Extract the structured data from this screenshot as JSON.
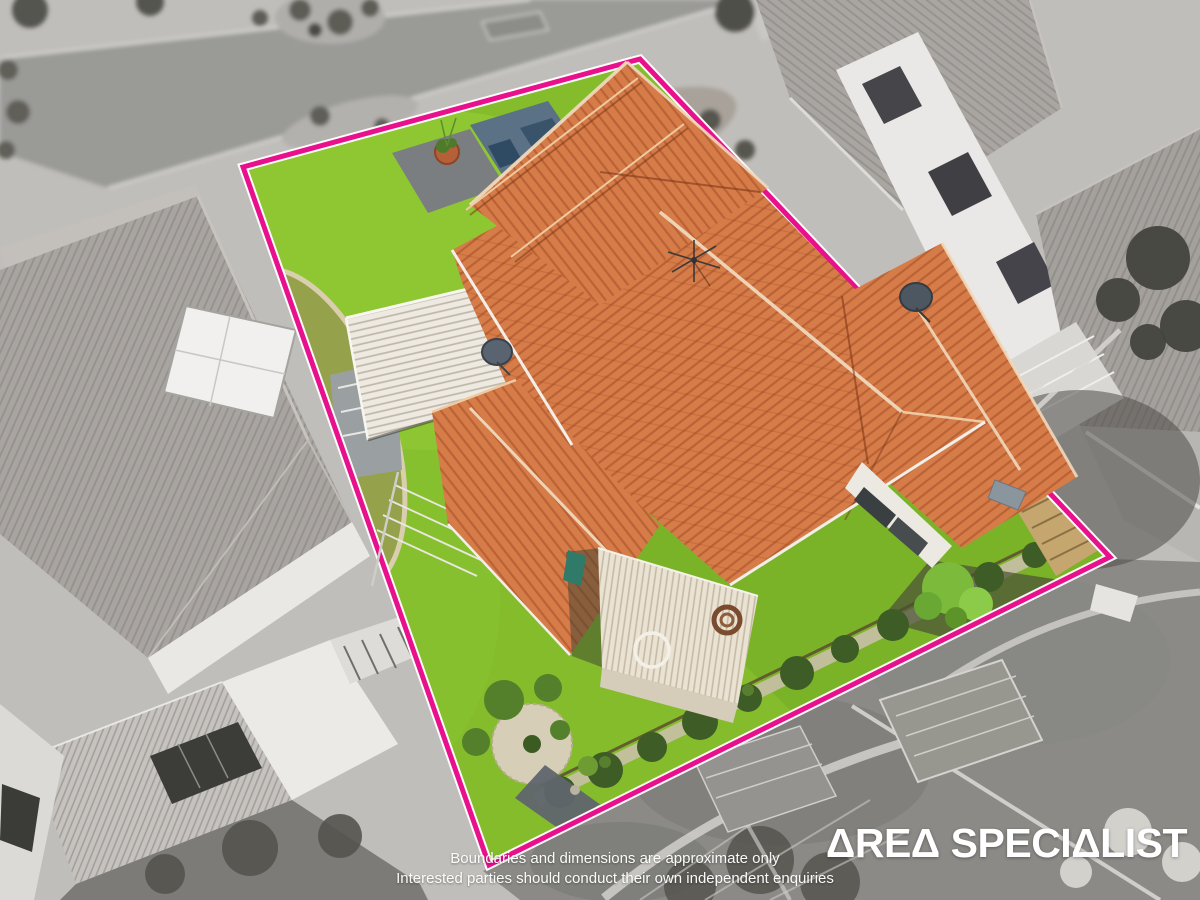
{
  "canvas": {
    "width": 1200,
    "height": 900
  },
  "scene": {
    "type": "aerial drone photograph of a residential property",
    "subject": "single-storey house with terracotta tiled hip roof, white corrugated carport, garden shed, lawn and garden beds shown in full colour",
    "surroundings": "street, driveways and neighbouring grey tiled houses shown desaturated (grayscale)",
    "boundary": {
      "label": "highlighted property boundary",
      "shape": "quadrilateral",
      "corners": [
        [
          243,
          167
        ],
        [
          640,
          59
        ],
        [
          1110,
          557
        ],
        [
          489,
          865
        ]
      ]
    }
  },
  "colors": {
    "boundary": "#e8108c",
    "boundaryOutline": "#ffffff",
    "lawn": "#84bc2c",
    "roof": "#d67c49",
    "overlayText": "#ffffff"
  },
  "overlay": {
    "disclaimer": {
      "line1": "Boundaries and dimensions are approximate only",
      "line2": "Interested parties should conduct their own independent enquiries"
    },
    "logo": {
      "text": "AREA SPECIALIST",
      "display": "ΔREΔ SPECIΔLIST"
    }
  }
}
